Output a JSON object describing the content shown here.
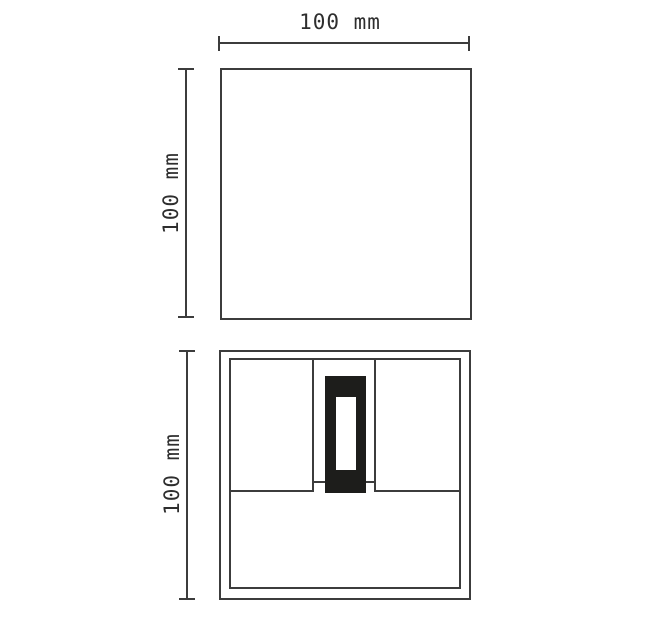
{
  "drawing": {
    "type": "technical-dimension-drawing",
    "front_view": {
      "width_label": "100 mm",
      "height_label": "100 mm"
    },
    "back_view": {
      "height_label": "100 mm"
    },
    "colors": {
      "line": "#3c3c3c",
      "text": "#2e2e2e",
      "bracket_fill": "#1d1d1b",
      "background": "#ffffff"
    }
  }
}
